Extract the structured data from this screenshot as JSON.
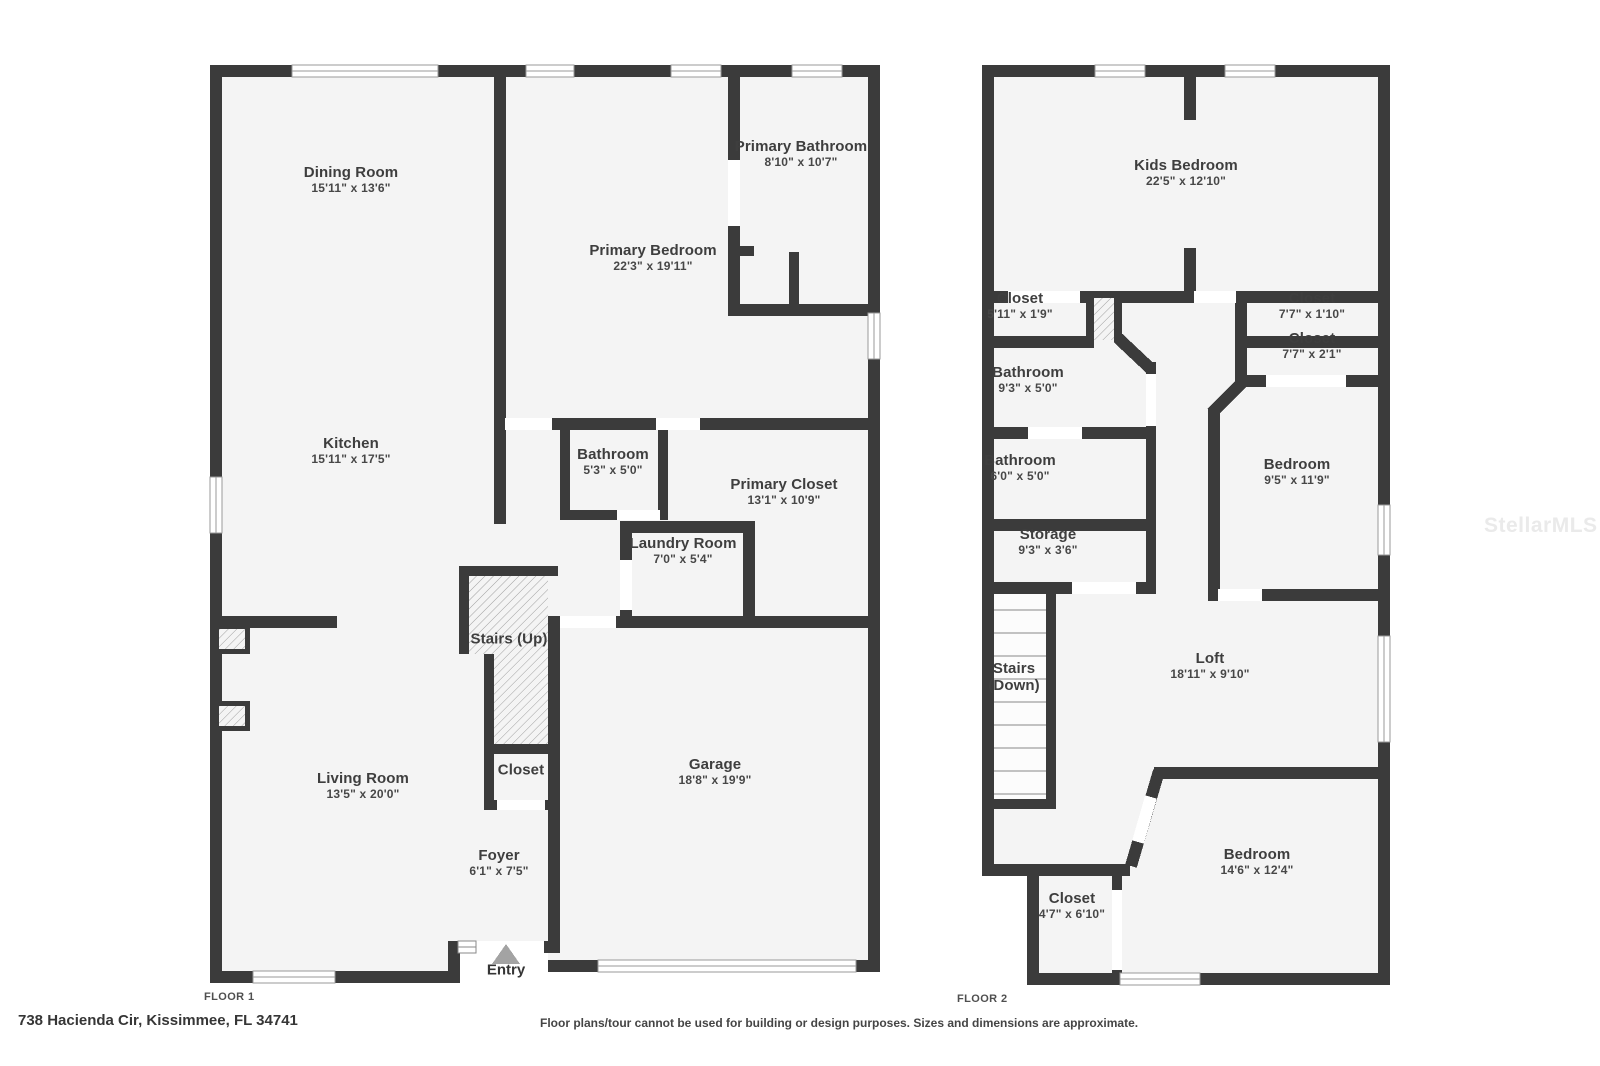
{
  "colors": {
    "wall": "#3b3b3b",
    "room_fill": "#f4f4f4",
    "label_text": "#3e3e3e",
    "hatch_line": "#a0a0a0",
    "entry_triangle": "#a3a3a3",
    "watermark": "#eaeaea"
  },
  "watermark": {
    "text": "StellarMLS"
  },
  "entry": {
    "label": "Entry",
    "x": 506,
    "y": 970
  },
  "floors": [
    {
      "tag": "FLOOR 1",
      "tag_pos": {
        "x": 204,
        "y": 997
      },
      "rooms": [
        {
          "name": "Dining Room",
          "dims": "15'11\" x 13'6\"",
          "x": 351,
          "y": 180
        },
        {
          "name": "Kitchen",
          "dims": "15'11\" x 17'5\"",
          "x": 351,
          "y": 451
        },
        {
          "name": "Primary Bathroom",
          "dims": "8'10\" x 10'7\"",
          "x": 801,
          "y": 154
        },
        {
          "name": "Primary Bedroom",
          "dims": "22'3\" x 19'11\"",
          "x": 653,
          "y": 258
        },
        {
          "name": "Bathroom",
          "dims": "5'3\" x 5'0\"",
          "x": 613,
          "y": 462
        },
        {
          "name": "Primary Closet",
          "dims": "13'1\" x 10'9\"",
          "x": 784,
          "y": 492
        },
        {
          "name": "Laundry Room",
          "dims": "7'0\" x 5'4\"",
          "x": 683,
          "y": 551
        },
        {
          "name": "Stairs (Up)",
          "dims": "",
          "x": 509,
          "y": 639
        },
        {
          "name": "Closet",
          "dims": "",
          "x": 521,
          "y": 770
        },
        {
          "name": "Living Room",
          "dims": "13'5\" x 20'0\"",
          "x": 363,
          "y": 786
        },
        {
          "name": "Foyer",
          "dims": "6'1\" x 7'5\"",
          "x": 499,
          "y": 863
        },
        {
          "name": "Garage",
          "dims": "18'8\" x 19'9\"",
          "x": 715,
          "y": 772
        }
      ]
    },
    {
      "tag": "FLOOR 2",
      "tag_pos": {
        "x": 957,
        "y": 999
      },
      "rooms": [
        {
          "name": "Kids Bedroom",
          "dims": "22'5\" x 12'10\"",
          "x": 1186,
          "y": 173
        },
        {
          "name": "Closet",
          "dims": "5'11\" x 1'9\"",
          "x": 1020,
          "y": 306
        },
        {
          "name": "Closet",
          "dims": "7'7\" x 1'10\"",
          "x": 1312,
          "y": 306
        },
        {
          "name": "Closet",
          "dims": "7'7\" x 2'1\"",
          "x": 1312,
          "y": 346
        },
        {
          "name": "Bathroom",
          "dims": "9'3\" x 5'0\"",
          "x": 1028,
          "y": 380
        },
        {
          "name": "Bathroom",
          "dims": "6'0\" x 5'0\"",
          "x": 1020,
          "y": 468
        },
        {
          "name": "Storage",
          "dims": "9'3\" x 3'6\"",
          "x": 1048,
          "y": 542
        },
        {
          "name": "Stairs",
          "name2": "(Down)",
          "dims": "",
          "x": 1014,
          "y": 677
        },
        {
          "name": "Loft",
          "dims": "18'11\" x 9'10\"",
          "x": 1210,
          "y": 666
        },
        {
          "name": "Bedroom",
          "dims": "9'5\" x 11'9\"",
          "x": 1297,
          "y": 472
        },
        {
          "name": "Bedroom",
          "dims": "14'6\" x 12'4\"",
          "x": 1257,
          "y": 862
        },
        {
          "name": "Closet",
          "dims": "4'7\" x 6'10\"",
          "x": 1072,
          "y": 906
        }
      ]
    }
  ],
  "footer": {
    "address": "738 Hacienda Cir, Kissimmee, FL 34741",
    "disclaimer": "Floor plans/tour cannot be used for building or design purposes. Sizes and dimensions are approximate."
  }
}
